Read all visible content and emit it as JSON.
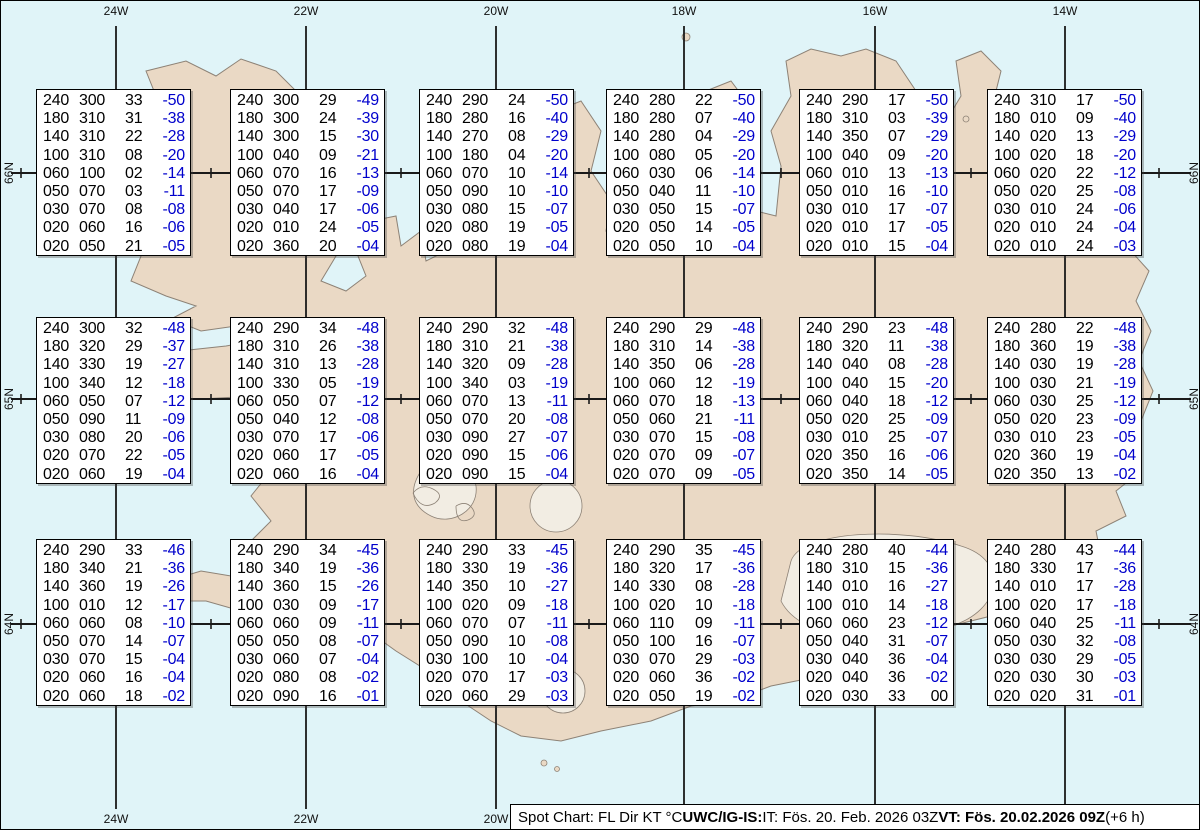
{
  "chart_title": "Spot Chart",
  "status_bar": {
    "prefix": "Spot Chart: FL Dir KT °C ",
    "bold1": "UWC/IG-IS:",
    "mid": " IT: Fös. 20. Feb. 2026 03Z ",
    "bold2": "VT: Fös. 20.02.2026 09Z",
    "suffix": " (+6 h)"
  },
  "map_colors": {
    "water": "#e0f4f8",
    "land": "#ead9c5",
    "coast": "#8d8276",
    "glacier": "#f2ede3",
    "grid": "#1a1a1a",
    "temp_blue": "#0000cc",
    "text_black": "#000000"
  },
  "graticule": {
    "meridians": [
      {
        "label": "24W",
        "x": 115
      },
      {
        "label": "22W",
        "x": 305
      },
      {
        "label": "20W",
        "x": 495
      },
      {
        "label": "18W",
        "x": 683
      },
      {
        "label": "16W",
        "x": 874
      },
      {
        "label": "14W",
        "x": 1064
      }
    ],
    "parallels": [
      {
        "label": "66N",
        "y": 172
      },
      {
        "label": "65N",
        "y": 398
      },
      {
        "label": "64N",
        "y": 623
      }
    ],
    "spot_marker_x": [
      20,
      210,
      400,
      588,
      780,
      970,
      1158
    ]
  },
  "layout": {
    "box_lefts": [
      35,
      229,
      418,
      605,
      798,
      986
    ],
    "box_tops": [
      88,
      316,
      538
    ]
  },
  "spot_boxes": [
    {
      "row": 1,
      "col": 1,
      "lines": [
        [
          "240",
          "300",
          "33",
          "-50"
        ],
        [
          "180",
          "310",
          "31",
          "-38"
        ],
        [
          "140",
          "310",
          "22",
          "-28"
        ],
        [
          "100",
          "310",
          "08",
          "-20"
        ],
        [
          "060",
          "100",
          "02",
          "-14"
        ],
        [
          "050",
          "070",
          "03",
          "-11"
        ],
        [
          "030",
          "070",
          "08",
          "-08"
        ],
        [
          "020",
          "060",
          "16",
          "-06"
        ],
        [
          "020",
          "050",
          "21",
          "-05"
        ]
      ]
    },
    {
      "row": 1,
      "col": 2,
      "lines": [
        [
          "240",
          "300",
          "29",
          "-49"
        ],
        [
          "180",
          "300",
          "24",
          "-39"
        ],
        [
          "140",
          "300",
          "15",
          "-30"
        ],
        [
          "100",
          "040",
          "09",
          "-21"
        ],
        [
          "060",
          "070",
          "16",
          "-13"
        ],
        [
          "050",
          "070",
          "17",
          "-09"
        ],
        [
          "030",
          "040",
          "17",
          "-06"
        ],
        [
          "020",
          "010",
          "24",
          "-05"
        ],
        [
          "020",
          "360",
          "20",
          "-04"
        ]
      ]
    },
    {
      "row": 1,
      "col": 3,
      "lines": [
        [
          "240",
          "290",
          "24",
          "-50"
        ],
        [
          "180",
          "280",
          "16",
          "-40"
        ],
        [
          "140",
          "270",
          "08",
          "-29"
        ],
        [
          "100",
          "180",
          "04",
          "-20"
        ],
        [
          "060",
          "070",
          "10",
          "-14"
        ],
        [
          "050",
          "090",
          "10",
          "-10"
        ],
        [
          "030",
          "080",
          "15",
          "-07"
        ],
        [
          "020",
          "080",
          "19",
          "-05"
        ],
        [
          "020",
          "080",
          "19",
          "-04"
        ]
      ]
    },
    {
      "row": 1,
      "col": 4,
      "lines": [
        [
          "240",
          "280",
          "22",
          "-50"
        ],
        [
          "180",
          "280",
          "07",
          "-40"
        ],
        [
          "140",
          "280",
          "04",
          "-29"
        ],
        [
          "100",
          "080",
          "05",
          "-20"
        ],
        [
          "060",
          "030",
          "06",
          "-14"
        ],
        [
          "050",
          "040",
          "11",
          "-10"
        ],
        [
          "030",
          "050",
          "15",
          "-07"
        ],
        [
          "020",
          "050",
          "14",
          "-05"
        ],
        [
          "020",
          "050",
          "10",
          "-04"
        ]
      ]
    },
    {
      "row": 1,
      "col": 5,
      "lines": [
        [
          "240",
          "290",
          "17",
          "-50"
        ],
        [
          "180",
          "310",
          "03",
          "-39"
        ],
        [
          "140",
          "350",
          "07",
          "-29"
        ],
        [
          "100",
          "040",
          "09",
          "-20"
        ],
        [
          "060",
          "010",
          "13",
          "-13"
        ],
        [
          "050",
          "010",
          "16",
          "-10"
        ],
        [
          "030",
          "010",
          "17",
          "-07"
        ],
        [
          "020",
          "010",
          "17",
          "-05"
        ],
        [
          "020",
          "010",
          "15",
          "-04"
        ]
      ]
    },
    {
      "row": 1,
      "col": 6,
      "lines": [
        [
          "240",
          "310",
          "17",
          "-50"
        ],
        [
          "180",
          "010",
          "09",
          "-40"
        ],
        [
          "140",
          "020",
          "13",
          "-29"
        ],
        [
          "100",
          "020",
          "18",
          "-20"
        ],
        [
          "060",
          "020",
          "22",
          "-12"
        ],
        [
          "050",
          "020",
          "25",
          "-08"
        ],
        [
          "030",
          "010",
          "24",
          "-06"
        ],
        [
          "020",
          "010",
          "24",
          "-04"
        ],
        [
          "020",
          "010",
          "24",
          "-03"
        ]
      ]
    },
    {
      "row": 2,
      "col": 1,
      "lines": [
        [
          "240",
          "300",
          "32",
          "-48"
        ],
        [
          "180",
          "320",
          "29",
          "-37"
        ],
        [
          "140",
          "330",
          "19",
          "-27"
        ],
        [
          "100",
          "340",
          "12",
          "-18"
        ],
        [
          "060",
          "050",
          "07",
          "-12"
        ],
        [
          "050",
          "090",
          "11",
          "-09"
        ],
        [
          "030",
          "080",
          "20",
          "-06"
        ],
        [
          "020",
          "070",
          "22",
          "-05"
        ],
        [
          "020",
          "060",
          "19",
          "-04"
        ]
      ]
    },
    {
      "row": 2,
      "col": 2,
      "lines": [
        [
          "240",
          "290",
          "34",
          "-48"
        ],
        [
          "180",
          "310",
          "26",
          "-38"
        ],
        [
          "140",
          "310",
          "13",
          "-28"
        ],
        [
          "100",
          "330",
          "05",
          "-19"
        ],
        [
          "060",
          "050",
          "07",
          "-12"
        ],
        [
          "050",
          "040",
          "12",
          "-08"
        ],
        [
          "030",
          "070",
          "17",
          "-06"
        ],
        [
          "020",
          "060",
          "17",
          "-05"
        ],
        [
          "020",
          "060",
          "16",
          "-04"
        ]
      ]
    },
    {
      "row": 2,
      "col": 3,
      "lines": [
        [
          "240",
          "290",
          "32",
          "-48"
        ],
        [
          "180",
          "310",
          "21",
          "-38"
        ],
        [
          "140",
          "320",
          "09",
          "-28"
        ],
        [
          "100",
          "340",
          "03",
          "-19"
        ],
        [
          "060",
          "070",
          "13",
          "-11"
        ],
        [
          "050",
          "070",
          "20",
          "-08"
        ],
        [
          "030",
          "090",
          "27",
          "-07"
        ],
        [
          "020",
          "090",
          "15",
          "-06"
        ],
        [
          "020",
          "090",
          "15",
          "-04"
        ]
      ]
    },
    {
      "row": 2,
      "col": 4,
      "lines": [
        [
          "240",
          "290",
          "29",
          "-48"
        ],
        [
          "180",
          "310",
          "14",
          "-38"
        ],
        [
          "140",
          "350",
          "06",
          "-28"
        ],
        [
          "100",
          "060",
          "12",
          "-19"
        ],
        [
          "060",
          "070",
          "18",
          "-13"
        ],
        [
          "050",
          "060",
          "21",
          "-11"
        ],
        [
          "030",
          "070",
          "15",
          "-08"
        ],
        [
          "020",
          "070",
          "09",
          "-07"
        ],
        [
          "020",
          "070",
          "09",
          "-05"
        ]
      ]
    },
    {
      "row": 2,
      "col": 5,
      "lines": [
        [
          "240",
          "290",
          "23",
          "-48"
        ],
        [
          "180",
          "320",
          "11",
          "-38"
        ],
        [
          "140",
          "040",
          "08",
          "-28"
        ],
        [
          "100",
          "040",
          "15",
          "-20"
        ],
        [
          "060",
          "040",
          "18",
          "-12"
        ],
        [
          "050",
          "020",
          "25",
          "-09"
        ],
        [
          "030",
          "010",
          "25",
          "-07"
        ],
        [
          "020",
          "350",
          "16",
          "-06"
        ],
        [
          "020",
          "350",
          "14",
          "-05"
        ]
      ]
    },
    {
      "row": 2,
      "col": 6,
      "lines": [
        [
          "240",
          "280",
          "22",
          "-48"
        ],
        [
          "180",
          "360",
          "19",
          "-38"
        ],
        [
          "140",
          "030",
          "19",
          "-28"
        ],
        [
          "100",
          "030",
          "21",
          "-19"
        ],
        [
          "060",
          "030",
          "25",
          "-12"
        ],
        [
          "050",
          "020",
          "23",
          "-09"
        ],
        [
          "030",
          "010",
          "23",
          "-05"
        ],
        [
          "020",
          "360",
          "19",
          "-04"
        ],
        [
          "020",
          "350",
          "13",
          "-02"
        ]
      ]
    },
    {
      "row": 3,
      "col": 1,
      "lines": [
        [
          "240",
          "290",
          "33",
          "-46"
        ],
        [
          "180",
          "340",
          "21",
          "-36"
        ],
        [
          "140",
          "360",
          "19",
          "-26"
        ],
        [
          "100",
          "010",
          "12",
          "-17"
        ],
        [
          "060",
          "060",
          "08",
          "-10"
        ],
        [
          "050",
          "070",
          "14",
          "-07"
        ],
        [
          "030",
          "070",
          "15",
          "-04"
        ],
        [
          "020",
          "060",
          "16",
          "-04"
        ],
        [
          "020",
          "060",
          "18",
          "-02"
        ]
      ]
    },
    {
      "row": 3,
      "col": 2,
      "lines": [
        [
          "240",
          "290",
          "34",
          "-45"
        ],
        [
          "180",
          "340",
          "19",
          "-36"
        ],
        [
          "140",
          "360",
          "15",
          "-26"
        ],
        [
          "100",
          "030",
          "09",
          "-17"
        ],
        [
          "060",
          "060",
          "09",
          "-11"
        ],
        [
          "050",
          "050",
          "08",
          "-07"
        ],
        [
          "030",
          "060",
          "07",
          "-04"
        ],
        [
          "020",
          "080",
          "08",
          "-02"
        ],
        [
          "020",
          "090",
          "16",
          "-01"
        ]
      ]
    },
    {
      "row": 3,
      "col": 3,
      "lines": [
        [
          "240",
          "290",
          "33",
          "-45"
        ],
        [
          "180",
          "330",
          "19",
          "-36"
        ],
        [
          "140",
          "350",
          "10",
          "-27"
        ],
        [
          "100",
          "020",
          "09",
          "-18"
        ],
        [
          "060",
          "070",
          "07",
          "-11"
        ],
        [
          "050",
          "090",
          "10",
          "-08"
        ],
        [
          "030",
          "100",
          "10",
          "-04"
        ],
        [
          "020",
          "070",
          "17",
          "-03"
        ],
        [
          "020",
          "060",
          "29",
          "-03"
        ]
      ]
    },
    {
      "row": 3,
      "col": 4,
      "lines": [
        [
          "240",
          "290",
          "35",
          "-45"
        ],
        [
          "180",
          "320",
          "17",
          "-36"
        ],
        [
          "140",
          "330",
          "08",
          "-28"
        ],
        [
          "100",
          "020",
          "10",
          "-18"
        ],
        [
          "060",
          "110",
          "09",
          "-11"
        ],
        [
          "050",
          "100",
          "16",
          "-07"
        ],
        [
          "030",
          "070",
          "29",
          "-03"
        ],
        [
          "020",
          "060",
          "36",
          "-02"
        ],
        [
          "020",
          "050",
          "19",
          "-02"
        ]
      ]
    },
    {
      "row": 3,
      "col": 5,
      "lines": [
        [
          "240",
          "280",
          "40",
          "-44"
        ],
        [
          "180",
          "310",
          "15",
          "-36"
        ],
        [
          "140",
          "010",
          "16",
          "-27"
        ],
        [
          "100",
          "010",
          "14",
          "-18"
        ],
        [
          "060",
          "060",
          "23",
          "-12"
        ],
        [
          "050",
          "040",
          "31",
          "-07"
        ],
        [
          "030",
          "040",
          "36",
          "-04"
        ],
        [
          "020",
          "040",
          "36",
          "-02"
        ],
        [
          "020",
          "030",
          "33",
          "00"
        ]
      ]
    },
    {
      "row": 3,
      "col": 6,
      "lines": [
        [
          "240",
          "280",
          "43",
          "-44"
        ],
        [
          "180",
          "330",
          "17",
          "-36"
        ],
        [
          "140",
          "010",
          "17",
          "-28"
        ],
        [
          "100",
          "020",
          "17",
          "-18"
        ],
        [
          "060",
          "040",
          "25",
          "-11"
        ],
        [
          "050",
          "030",
          "32",
          "-08"
        ],
        [
          "030",
          "030",
          "29",
          "-05"
        ],
        [
          "020",
          "030",
          "30",
          "-03"
        ],
        [
          "020",
          "020",
          "31",
          "-01"
        ]
      ]
    }
  ]
}
